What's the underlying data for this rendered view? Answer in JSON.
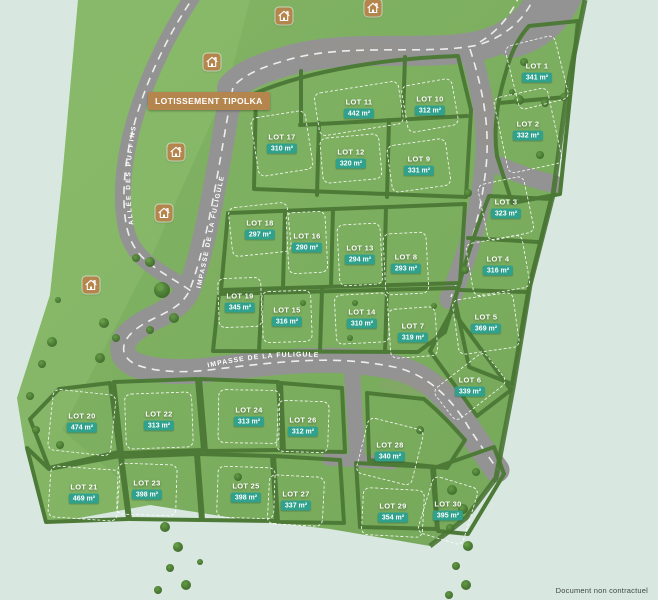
{
  "map": {
    "title": "LOTISSEMENT TIPOLKA",
    "disclaimer": "Document non contractuel",
    "area_unit": "m²",
    "streets": [
      {
        "name": "ALLÉE DES PUFFINS"
      },
      {
        "name": "IMPASSE DE LA FULIGULE"
      },
      {
        "name": "IMPASSE DE LA FULIGULE"
      }
    ],
    "colors": {
      "background": "#d8e8e1",
      "grass": "#7cae5f",
      "grass_light": "#8cbd6e",
      "road": "#939393",
      "hedge": "#4d7b37",
      "badge_teal": "#2fa18d",
      "accent_tan": "#b5854e",
      "dash_white": "#f2f2f2"
    },
    "lots": [
      {
        "label": "LOT 1",
        "area": "341 m²",
        "x": 537,
        "y": 72,
        "w": 50,
        "h": 64,
        "rot": -14
      },
      {
        "label": "LOT 2",
        "area": "332 m²",
        "x": 528,
        "y": 130,
        "w": 54,
        "h": 76,
        "rot": -12
      },
      {
        "label": "LOT 3",
        "area": "323 m²",
        "x": 506,
        "y": 208,
        "w": 46,
        "h": 56,
        "rot": -12
      },
      {
        "label": "LOT 4",
        "area": "316 m²",
        "x": 498,
        "y": 265,
        "w": 56,
        "h": 52,
        "rot": -10
      },
      {
        "label": "LOT 5",
        "area": "369 m²",
        "x": 486,
        "y": 323,
        "w": 60,
        "h": 54,
        "rot": -8
      },
      {
        "label": "LOT 6",
        "area": "339 m²",
        "x": 470,
        "y": 386,
        "w": 64,
        "h": 38,
        "rot": -38
      },
      {
        "label": "LOT 7",
        "area": "319 m²",
        "x": 413,
        "y": 332,
        "w": 46,
        "h": 48,
        "rot": -4
      },
      {
        "label": "LOT 8",
        "area": "293 m²",
        "x": 406,
        "y": 263,
        "w": 42,
        "h": 60,
        "rot": -3
      },
      {
        "label": "LOT 9",
        "area": "331 m²",
        "x": 419,
        "y": 165,
        "w": 58,
        "h": 46,
        "rot": -8
      },
      {
        "label": "LOT 10",
        "area": "312 m²",
        "x": 430,
        "y": 105,
        "w": 50,
        "h": 46,
        "rot": -10
      },
      {
        "label": "LOT 11",
        "area": "442 m²",
        "x": 359,
        "y": 108,
        "w": 84,
        "h": 42,
        "rot": -9
      },
      {
        "label": "LOT 12",
        "area": "320 m²",
        "x": 351,
        "y": 158,
        "w": 58,
        "h": 44,
        "rot": -5
      },
      {
        "label": "LOT 13",
        "area": "294 m²",
        "x": 360,
        "y": 254,
        "w": 42,
        "h": 60,
        "rot": -3
      },
      {
        "label": "LOT 14",
        "area": "310 m²",
        "x": 362,
        "y": 318,
        "w": 52,
        "h": 48,
        "rot": -3
      },
      {
        "label": "LOT 15",
        "area": "316 m²",
        "x": 287,
        "y": 316,
        "w": 48,
        "h": 50,
        "rot": -2
      },
      {
        "label": "LOT 16",
        "area": "290 m²",
        "x": 307,
        "y": 242,
        "w": 38,
        "h": 60,
        "rot": -3
      },
      {
        "label": "LOT 17",
        "area": "310 m²",
        "x": 282,
        "y": 143,
        "w": 54,
        "h": 58,
        "rot": -9
      },
      {
        "label": "LOT 18",
        "area": "297 m²",
        "x": 260,
        "y": 229,
        "w": 58,
        "h": 48,
        "rot": -6
      },
      {
        "label": "LOT 19",
        "area": "345 m²",
        "x": 240,
        "y": 302,
        "w": 42,
        "h": 48,
        "rot": -2
      },
      {
        "label": "LOT 20",
        "area": "474 m²",
        "x": 82,
        "y": 422,
        "w": 62,
        "h": 60,
        "rot": 6
      },
      {
        "label": "LOT 21",
        "area": "469 m²",
        "x": 84,
        "y": 493,
        "w": 68,
        "h": 50,
        "rot": 4
      },
      {
        "label": "LOT 22",
        "area": "313 m²",
        "x": 159,
        "y": 420,
        "w": 66,
        "h": 54,
        "rot": -2
      },
      {
        "label": "LOT 23",
        "area": "398 m²",
        "x": 147,
        "y": 489,
        "w": 58,
        "h": 50,
        "rot": 2
      },
      {
        "label": "LOT 24",
        "area": "313 m²",
        "x": 249,
        "y": 416,
        "w": 60,
        "h": 52,
        "rot": 1
      },
      {
        "label": "LOT 25",
        "area": "398 m²",
        "x": 246,
        "y": 492,
        "w": 56,
        "h": 50,
        "rot": 2
      },
      {
        "label": "LOT 26",
        "area": "312 m²",
        "x": 303,
        "y": 426,
        "w": 50,
        "h": 50,
        "rot": 2
      },
      {
        "label": "LOT 27",
        "area": "337 m²",
        "x": 296,
        "y": 500,
        "w": 54,
        "h": 48,
        "rot": 3
      },
      {
        "label": "LOT 28",
        "area": "340 m²",
        "x": 390,
        "y": 451,
        "w": 56,
        "h": 56,
        "rot": 14
      },
      {
        "label": "LOT 29",
        "area": "354 m²",
        "x": 393,
        "y": 512,
        "w": 60,
        "h": 46,
        "rot": 3
      },
      {
        "label": "LOT 30",
        "area": "395 m²",
        "x": 448,
        "y": 510,
        "w": 46,
        "h": 58,
        "rot": 17
      }
    ],
    "house_icons": [
      {
        "x": 284,
        "y": 16
      },
      {
        "x": 373,
        "y": 8
      },
      {
        "x": 212,
        "y": 62
      },
      {
        "x": 176,
        "y": 152
      },
      {
        "x": 164,
        "y": 213
      },
      {
        "x": 91,
        "y": 285
      }
    ]
  }
}
